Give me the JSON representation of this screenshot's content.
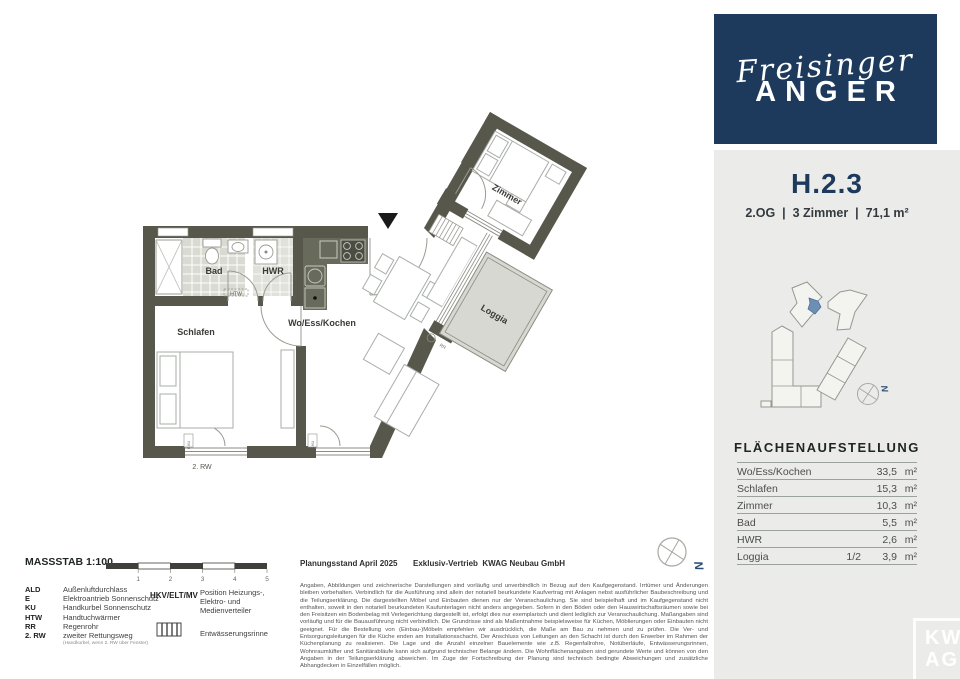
{
  "brand": {
    "script": "Freisinger",
    "caps": "ANGER"
  },
  "unit": {
    "id": "H.2.3",
    "meta": "2.OG  |  3 Zimmer  |  71,1 m²"
  },
  "areas": {
    "title": "FLÄCHENAUFSTELLUNG",
    "rows": [
      {
        "label": "Wo/Ess/Kochen",
        "frac": "",
        "value": "33,5",
        "unit": "m²"
      },
      {
        "label": "Schlafen",
        "frac": "",
        "value": "15,3",
        "unit": "m²"
      },
      {
        "label": "Zimmer",
        "frac": "",
        "value": "10,3",
        "unit": "m²"
      },
      {
        "label": "Bad",
        "frac": "",
        "value": "5,5",
        "unit": "m²"
      },
      {
        "label": "HWR",
        "frac": "",
        "value": "2,6",
        "unit": "m²"
      },
      {
        "label": "Loggia",
        "frac": "1/2",
        "value": "3,9",
        "unit": "m²"
      }
    ]
  },
  "plan": {
    "rooms": {
      "bad": "Bad",
      "hwr": "HWR",
      "schlafen": "Schlafen",
      "wek": "Wo/Ess/Kochen",
      "zimmer": "Zimmer",
      "loggia": "Loggia"
    },
    "marks": {
      "htw": "HTW",
      "hkv": "HKV/ELT/MV",
      "rw2": "2. RW",
      "rr": "RR",
      "eku": "E KU",
      "north": "N"
    }
  },
  "legend": {
    "scale_title": "MASSSTAB 1:100",
    "scale_ticks": [
      "1",
      "2",
      "3",
      "4",
      "5"
    ],
    "abbrev": [
      {
        "term": "ALD",
        "def": "Außenluftdurchlass"
      },
      {
        "term": "E",
        "def": "Elektroantrieb Sonnenschutz"
      },
      {
        "term": "KU",
        "def": "Handkurbel Sonnenschutz"
      },
      {
        "term": "HTW",
        "def": "Handtuchwärmer"
      },
      {
        "term": "RR",
        "def": "Regenrohr"
      },
      {
        "term": "2. RW",
        "def": "zweiter Rettungsweg"
      }
    ],
    "abbrev_note": "(Handkurbel, wenn 2. RW über Fenster)",
    "hkv_term": "HKV/ELT/MV",
    "hkv_def": "Position Heizungs-, Elektro- und Medienverteiler",
    "gutter": "Entwässerungsrinne"
  },
  "footer": {
    "planning": "Planungsstand April 2025",
    "sales": "Exklusiv-Vertrieb  KWAG Neubau GmbH",
    "disclaimer": "Angaben, Abbildungen und zeichnerische Darstellungen sind vorläufig und unverbindlich in Bezug auf den Kaufgegenstand. Irrtümer und Änderungen bleiben vorbehalten. Verbindlich für die Ausführung sind allein der notariell beurkundete Kaufvertrag mit Anlagen nebst ausführlicher Baubeschreibung und die Teilungserklärung. Die dargestellten Möbel und Einbauten dienen nur der Veranschaulichung. Sie sind beispielhaft und im Kaufgegenstand nicht enthalten, soweit in den notariell beurkundeten Kaufunterlagen nicht anders angegeben. Sofern in den Böden oder den Hauswirtschaftsräumen sowie bei den Freisitzen ein Bodenbelag mit Verlegerichtung dargestellt ist, erfolgt dies nur exemplarisch und dient lediglich zur Veranschaulichung. Maßangaben sind vorläufig und für die Bauausführung nicht verbindlich. Die Grundrisse sind als Maßentnahme beispielsweise für Küchen, Möblierungen oder Einbauten nicht geeignet. Für die Bestellung von (Einbau-)Möbeln empfehlen wir ausdrücklich, die Maße am Bau zu nehmen und zu prüfen. Die Ver- und Entsorgungsleitungen für die Küche enden am Installationsschacht. Der Anschluss von Leitungen an den Schacht ist durch den Erwerber im Rahmen der Küchenplanung zu realisieren. Die Lage und die Anzahl einzelner Bauelemente wie z.B. Regenfallrohre, Notüberläufe, Entwässerungsrinnen, Wohnraumlüfter und Sanitärabläufe kann sich aufgrund technischer Belange ändern. Die Wohnflächenangaben sind gerundete Werte und können von den Angaben in der Teilungserklärung abweichen. Im Zuge der Fortschreibung der Planung sind technisch bedingte Abweichungen und zusätzliche Abhangdecken in Einzelfällen möglich."
  },
  "watermark": {
    "l1": "KW",
    "l2": "AG"
  },
  "colors": {
    "navy": "#1d3a5c",
    "panel": "#ebecea",
    "wall": "#57584b",
    "accent_unit": "#6e8fb4"
  }
}
